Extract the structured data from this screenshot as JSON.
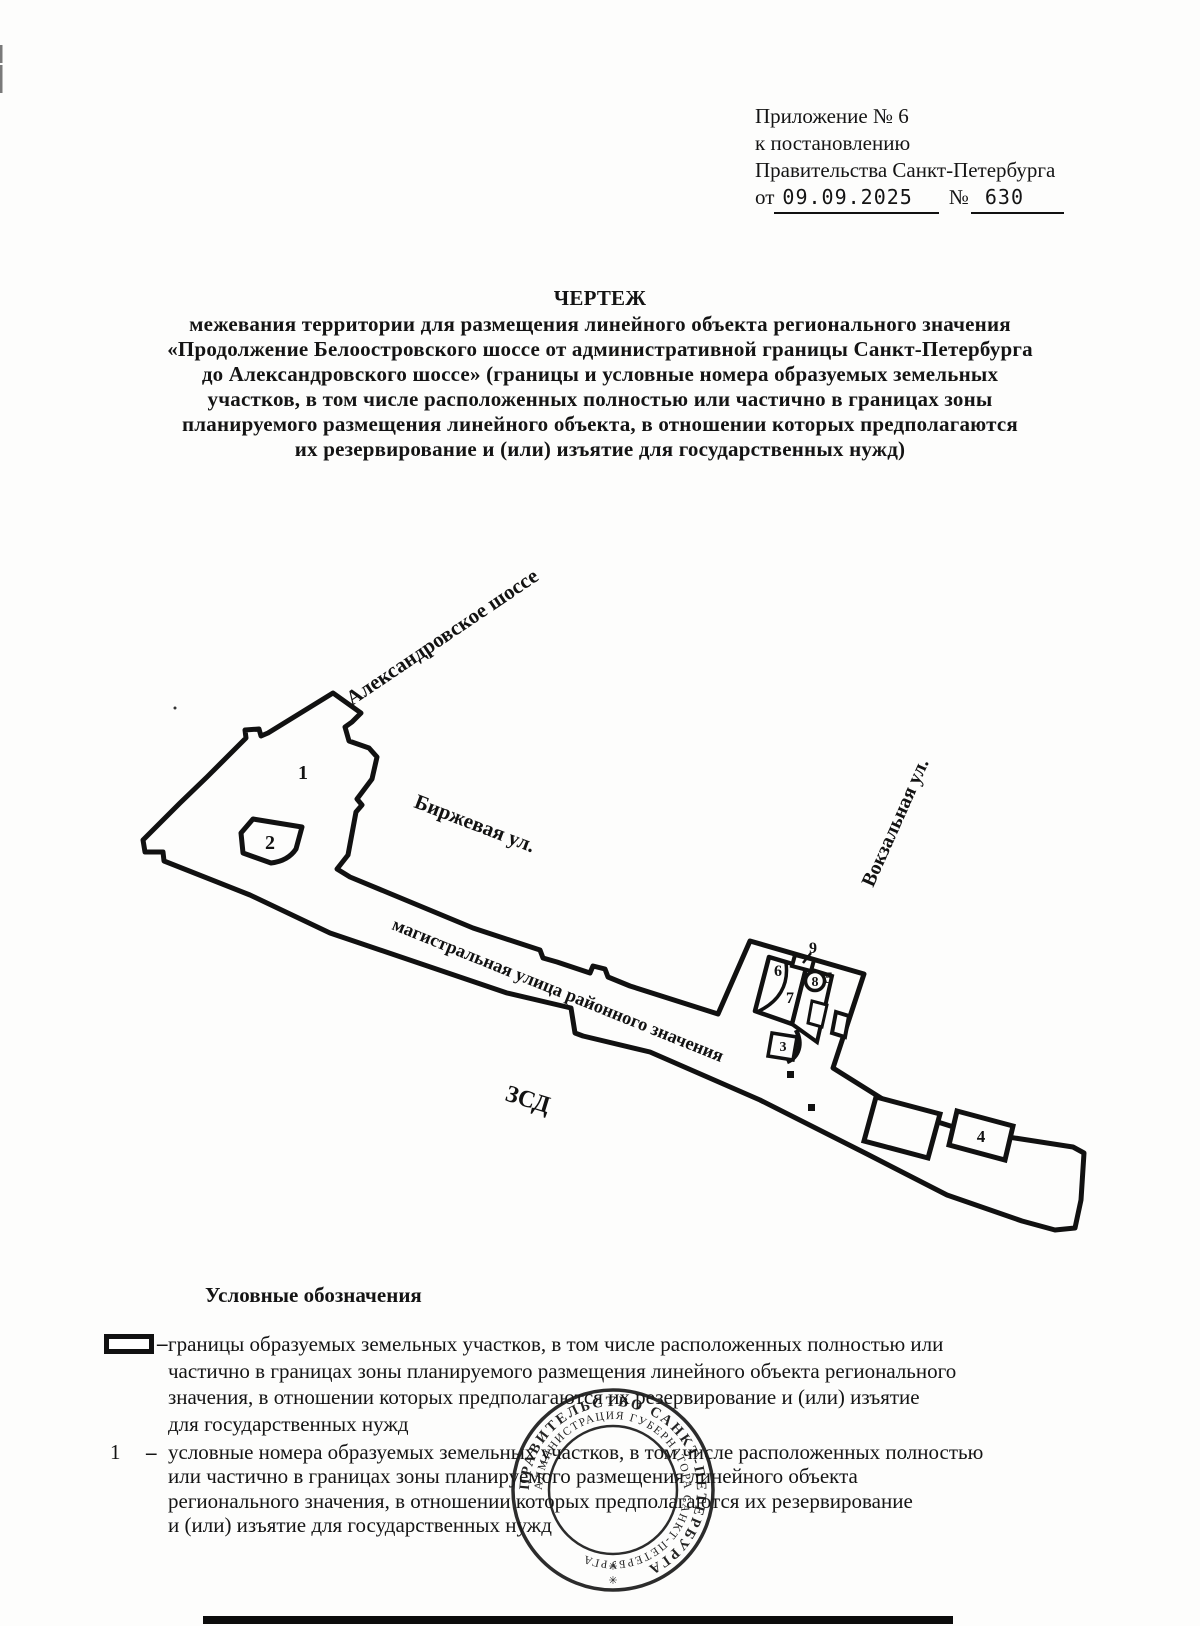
{
  "header": {
    "line1": "Приложение № 6",
    "line2": "к постановлению",
    "line3": "Правительства Санкт-Петербурга",
    "date_prefix": "от",
    "date": "09.09.2025",
    "num_sign": "№",
    "number": "630"
  },
  "title": {
    "heading": "ЧЕРТЕЖ",
    "lines": [
      "межевания территории для размещения линейного объекта регионального значения",
      "«Продолжение Белоостровского шоссе от административной границы Санкт-Петербурга",
      "до Александровского шоссе» (границы и условные номера образуемых земельных",
      "участков, в том числе расположенных полностью или частично в границах зоны",
      "планируемого размещения линейного объекта, в отношении которых предполагаются",
      "их резервирование и (или) изъятие для государственных нужд)"
    ]
  },
  "map": {
    "streets": {
      "alexandrovskoe": "Александровское шоссе",
      "birzhevaya": "Биржевая ул.",
      "vokzalnaya": "Вокзальная ул.",
      "magistralnaya": "магистральная улица районного значения",
      "zsd": "ЗСД"
    },
    "parcels": {
      "p1": "1",
      "p2": "2",
      "p3": "3",
      "p4": "4",
      "p5": "5",
      "p6": "6",
      "p7": "7",
      "p8": "8",
      "p9": "9"
    }
  },
  "legend": {
    "heading": "Условные обозначения",
    "dash": "–",
    "item1": {
      "lines": [
        "границы образуемых земельных участков, в том числе расположенных полностью или",
        "частично в границах зоны планируемого размещения линейного объекта  регионального",
        "значения, в отношении которых предполагаются их резервирование и (или) изъятие",
        "для государственных нужд"
      ]
    },
    "item2": {
      "symbol": "1",
      "lines": [
        "условные номера образуемых земельных участков, в том числе расположенных полностью",
        "или частично в границах зоны планируемого размещения линейного объекта",
        "регионального значения, в отношении которых предполагаются их резервирование",
        "и (или) изъятие для государственных нужд"
      ]
    }
  },
  "stamp": {
    "outer": "ПРАВИТЕЛЬСТВО САНКТ-ПЕТЕРБУРГА",
    "inner": "АДМИНИСТРАЦИЯ ГУБЕРНАТОРА САНКТ-ПЕТЕРБУРГА",
    "star1": "✳",
    "star2": "✳"
  }
}
